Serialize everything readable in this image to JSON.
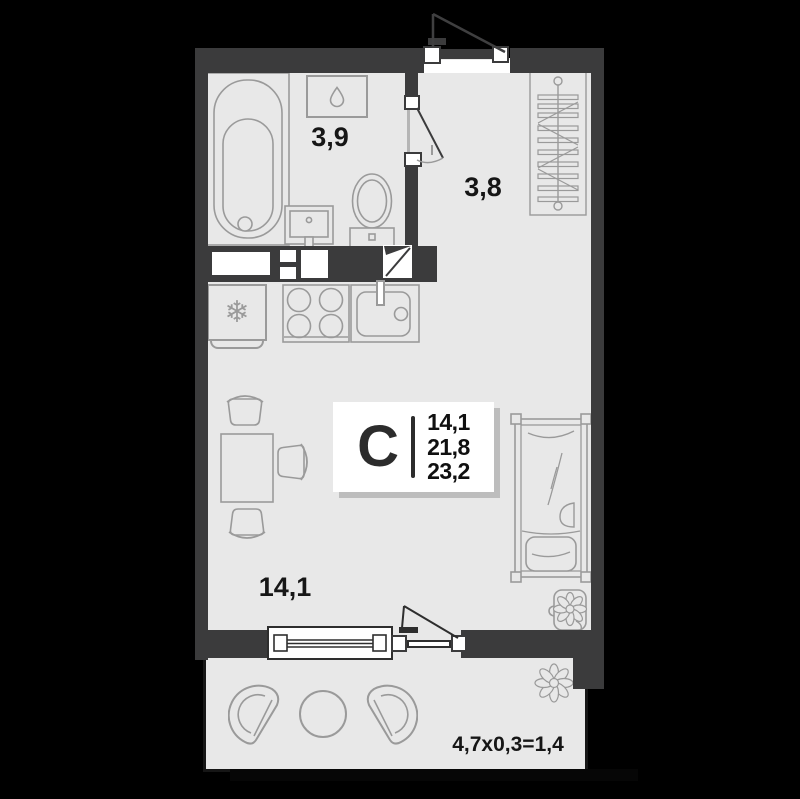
{
  "colors": {
    "background": "#000000",
    "wall": "#3b3b3c",
    "floor": "#e8e8e8",
    "line": "#9a9a9a",
    "text": "#161616",
    "shadow": "#bdbdbd"
  },
  "labels": {
    "bathroom": "3,9",
    "hallway": "3,8",
    "living": "14,1",
    "balcony": "4,7x0,3=1,4"
  },
  "info_box": {
    "letter": "С",
    "values": [
      "14,1",
      "21,8",
      "23,2"
    ]
  },
  "icons": {
    "snowflake": "❄",
    "water_heater": "droplet-outline",
    "bathtub": "tub-outline",
    "toilet": "toilet-outline",
    "bathroom_sink": "washbasin-outline",
    "wardrobe": "hanger-rail",
    "stove": "four-burners",
    "kitchen_sink": "basin-with-faucet",
    "dining_set": "table-with-three-chairs",
    "bed": "single-bed-with-pillow",
    "plant": "flower-in-pot",
    "balcony_flower": "flower",
    "balcony_set": "two-chairs-round-table"
  }
}
